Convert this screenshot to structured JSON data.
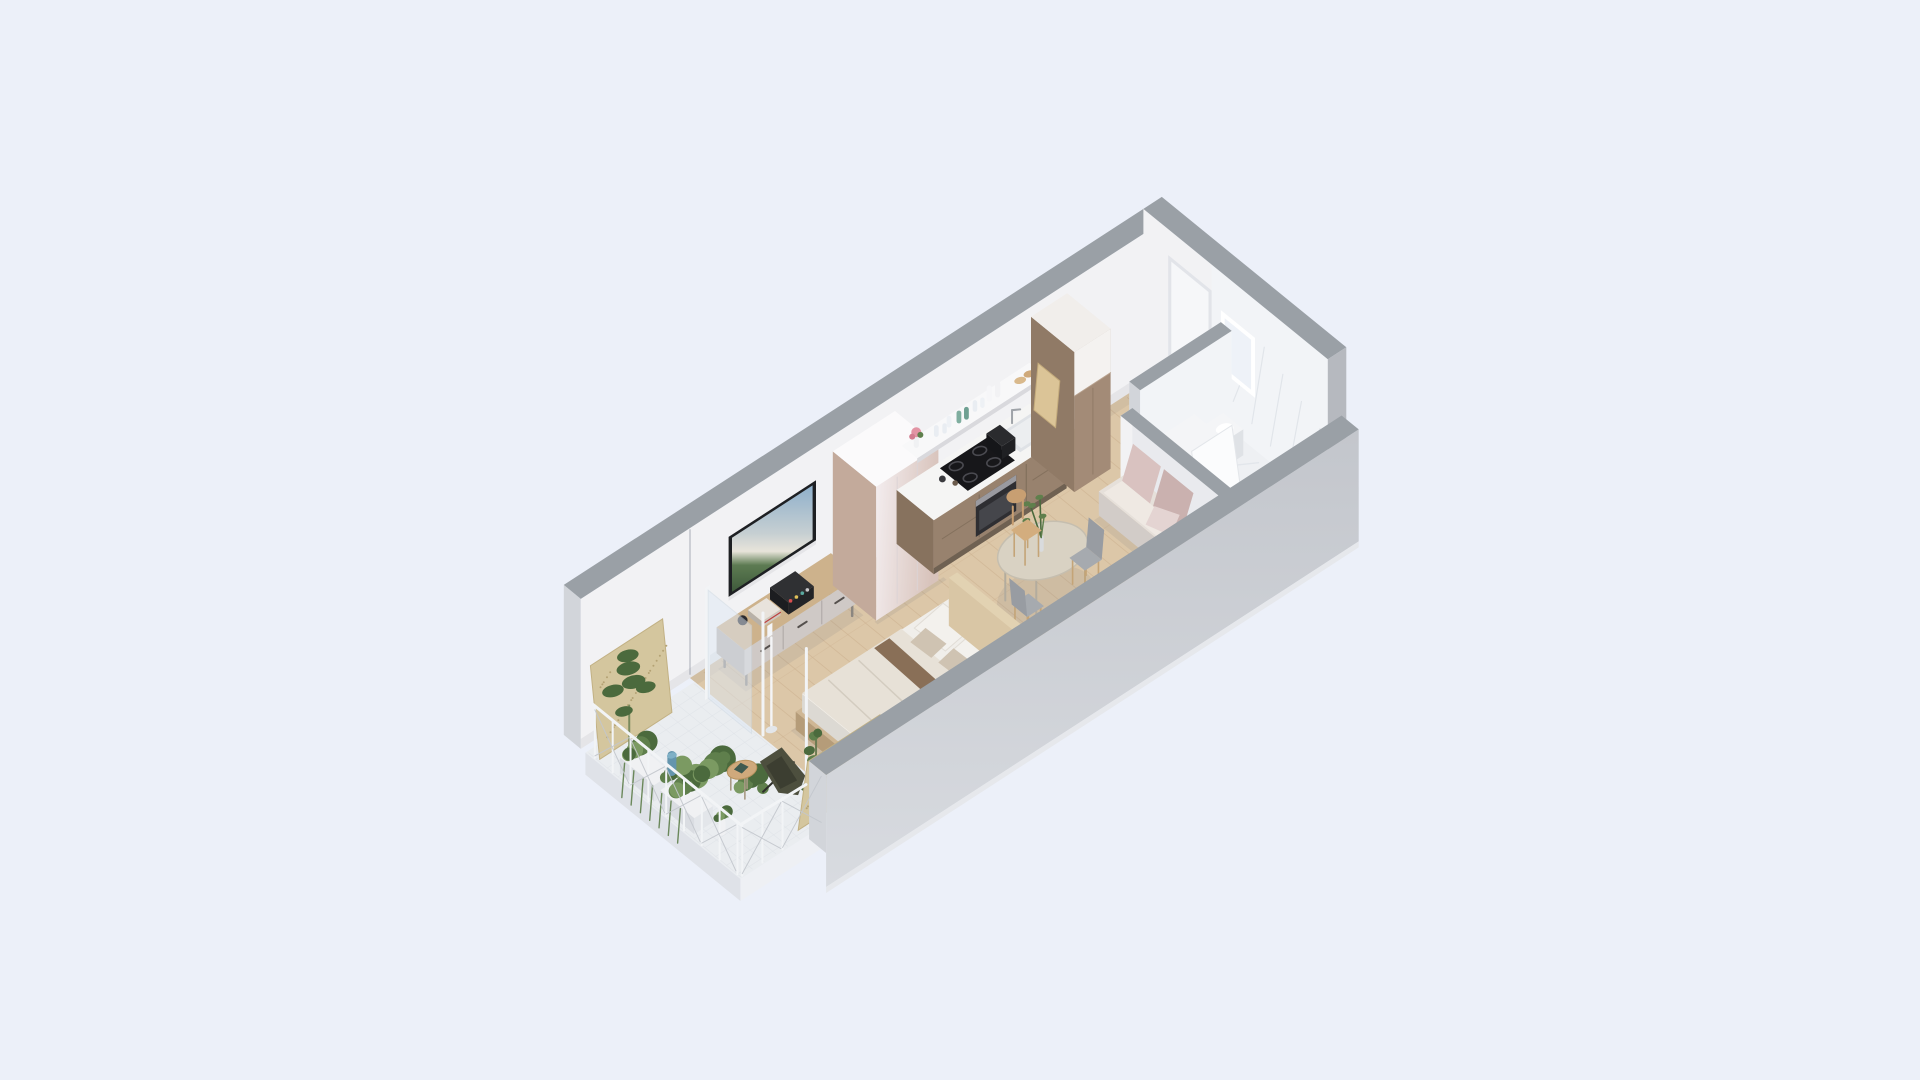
{
  "scene": {
    "name": "isometric-studio-apartment-3d-floor-plan",
    "rooms": [
      "balcony",
      "living-sleeping-area",
      "kitchen",
      "entry-hall",
      "bathroom"
    ],
    "objects": [
      "balcony-plants",
      "osb-panels",
      "butterfly-chair",
      "side-table",
      "railing",
      "glass-balcony-door",
      "bed",
      "headboard",
      "floor-lamp",
      "tv",
      "tv-console",
      "wardrobe",
      "kitchen-counter",
      "cooktop",
      "oven",
      "sink",
      "toaster",
      "open-shelf",
      "tall-cabinet",
      "cutting-board",
      "dining-table",
      "dining-chairs",
      "vase-with-branches",
      "sofa",
      "bathroom-door",
      "washing-machine",
      "shower-tray",
      "laundry-basket",
      "toilet",
      "marble-walls"
    ]
  },
  "palette": {
    "bg": "#ecf0f9",
    "capGray": "#9aa0a6",
    "capDark": "#8f959b",
    "wallWhite": "#f2f2f4",
    "wallShade": "#e9eaee",
    "wallEnd": "#d2d5da",
    "outerFront": "#c3c6cc",
    "outerSide": "#b6b9bf",
    "outerLight": "#d8dbe0",
    "slabEdge": "#eef0f4",
    "woodFloor": "#dcc7a8",
    "woodLine": "#c9ad8b",
    "woodSeam": "#cdb190",
    "marbleFloor": "#eef0f3",
    "marbleVein": "#dee2e8",
    "marbleWall": "#f2f4f7",
    "tileFloor": "#eaedf0",
    "tileLine": "#dde1e6",
    "counterFront": "#98826e",
    "counterSide": "#87725e",
    "counterTop": "#f5f5f4",
    "counterKick": "#6f6152",
    "ovenDark": "#2e2e32",
    "steel": "#9a9aa0",
    "cooktop": "#17171a",
    "ring": "#4a4a50",
    "wardrobeSide": "#c3aa9b",
    "wardrobeTop": "#fbfafb",
    "seam": "#dcd4d6",
    "cabFront": "#a38b77",
    "cabSide": "#907a66",
    "cabTop": "#f1eeeb",
    "shelfWhite": "#f8f8f9",
    "shelfShade": "#d9d9dd",
    "consoleTop": "#cdb28c",
    "consoleBody": "#b9b3b1",
    "consoleDrawer": "#cfc9c6",
    "consoleLeg": "#8b8680",
    "tvFrame": "#1e2023",
    "sky": "#8fb0cb",
    "sea": "#c6cfd2",
    "land": "#5d7b52",
    "bedFrame": "#cfb795",
    "mattress": "#f0eeea",
    "duvet": "#e7e1d7",
    "duvetShade": "#d7d0c4",
    "pillowWhite": "#f3f1ed",
    "pillowTaupe": "#cfc3b2",
    "blanket": "#7e6349",
    "headboard": "#d9c6a5",
    "tableTop": "#d9d2c3",
    "tableEdge": "#c5beaf",
    "tableLeg": "#b3ac9e",
    "chairSeat": "#a6aaaf",
    "chairBack": "#989ca2",
    "chairWood": "#c4a477",
    "bentwood": "#c89f72",
    "sofaBase": "#ddd7d3",
    "sofaSeat": "#e6e0da",
    "cushionPink": "#d9c2c0",
    "cushionPink2": "#cab1af",
    "doorLeaf": "#f6f7f9",
    "doorFrame": "#e2e4e9",
    "handle": "#7e8187",
    "fixtureWhite": "#f4f5f7",
    "fixtureShade": "#dfe2e6",
    "drain": "#a9adb3",
    "osb": "#d4c69e",
    "osbDot": "#b4a274",
    "greenDark": "#4b6a3d",
    "green": "#5f7f4c",
    "greenLight": "#7b9a62",
    "planter": "#f0f1f3",
    "bluePot": "#6495ad",
    "teal": "#3f7d8c",
    "flowerPink": "#e294a4",
    "soil": "#6b5b4c",
    "railPost": "#f2f4f6",
    "railWire": "#c3c7cd",
    "glass": "#dfe9f4",
    "lampWhite": "#f4f5f7",
    "shadow": "rgba(90,95,115,0.10)",
    "ao": "rgba(70,75,90,0.07)"
  }
}
